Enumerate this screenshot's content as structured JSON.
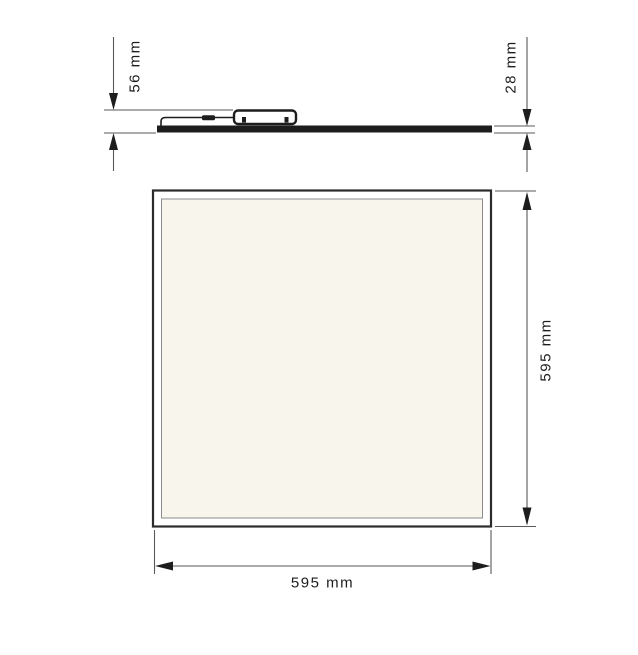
{
  "dimensions": {
    "profile_height": {
      "label": "56 mm"
    },
    "panel_thickness": {
      "label": "28 mm"
    },
    "panel_height": {
      "label": "595 mm"
    },
    "panel_width": {
      "label": "595 mm"
    }
  },
  "colors": {
    "outline": "#1d1d1d",
    "dimension_line": "#5a5a5a",
    "frame_stroke": "#2b2b2b",
    "inner_frame_stroke": "#8b8b8b",
    "panel_face_fill": "#f8f6ec",
    "background": "#ffffff"
  }
}
